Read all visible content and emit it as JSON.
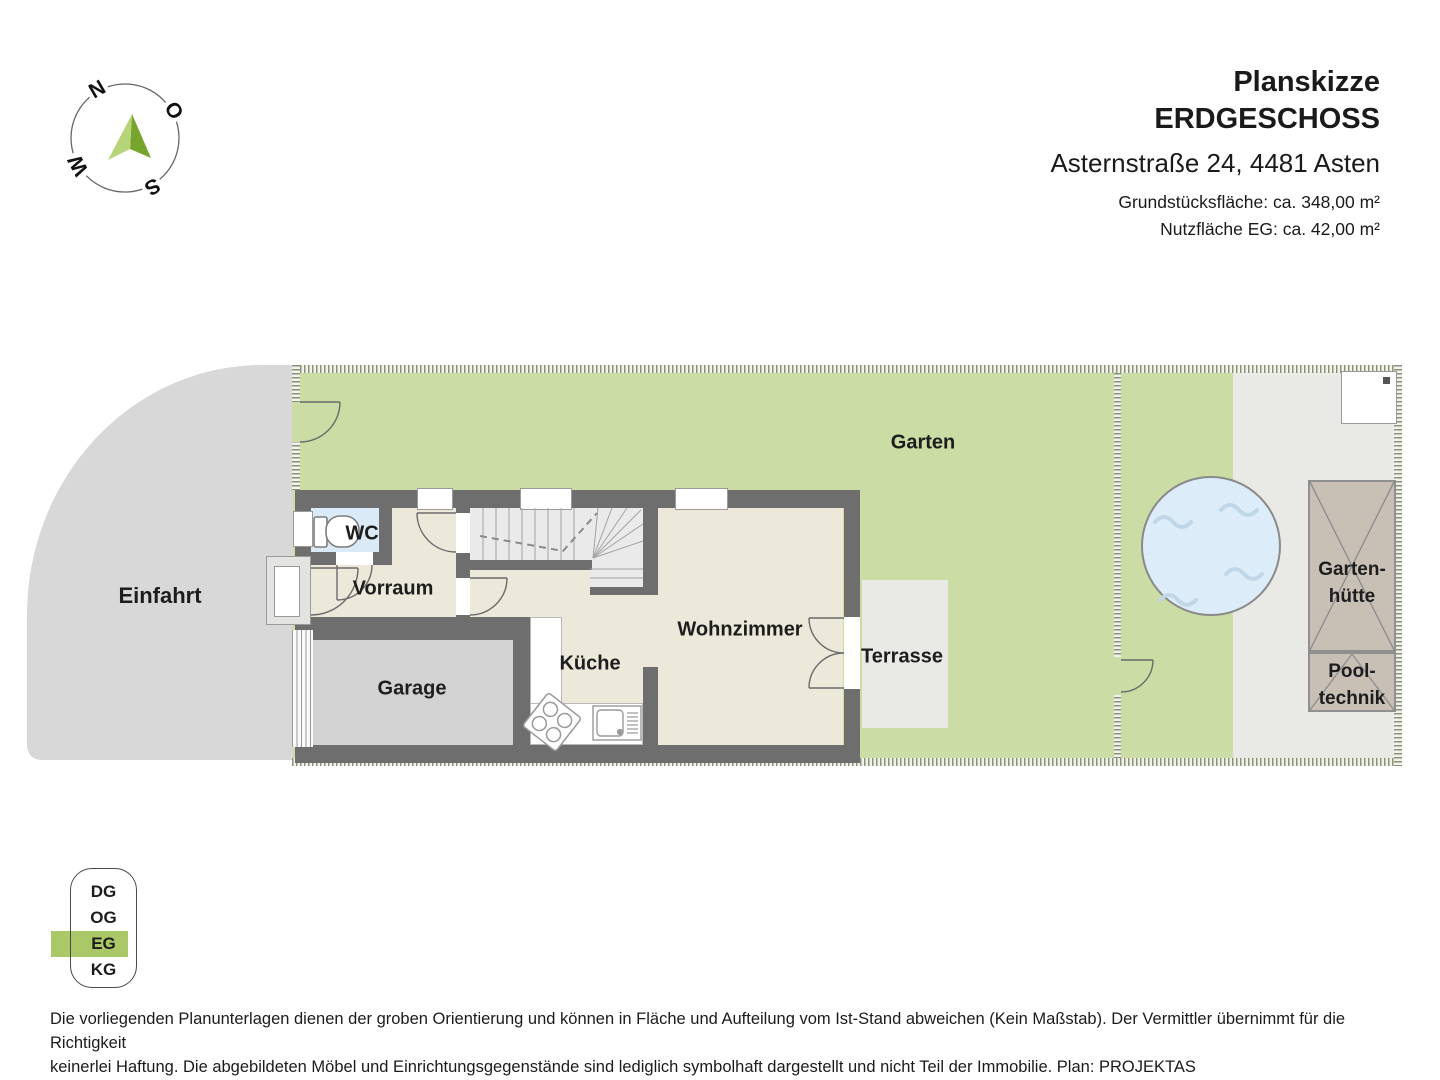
{
  "header": {
    "title_line1": "Planskizze",
    "title_line2": "ERDGESCHOSS",
    "address": "Asternstraße 24, 4481 Asten",
    "plot_area": "Grundstücksfläche: ca. 348,00 m²",
    "usable_area": "Nutzfläche EG: ca. 42,00 m²"
  },
  "compass": {
    "north": "N",
    "east": "O",
    "south": "S",
    "west": "W"
  },
  "plan": {
    "labels": {
      "einfahrt": "Einfahrt",
      "garten": "Garten",
      "wc": "WC",
      "vorraum": "Vorraum",
      "garage": "Garage",
      "kueche": "Küche",
      "wohnzimmer": "Wohnzimmer",
      "terrasse": "Terrasse",
      "gartenhuette_line1": "Garten-",
      "gartenhuette_line2": "hütte",
      "pooltechnik_line1": "Pool-",
      "pooltechnik_line2": "technik"
    }
  },
  "floor_selector": {
    "items": [
      {
        "label": "DG",
        "active": false
      },
      {
        "label": "OG",
        "active": false
      },
      {
        "label": "EG",
        "active": true
      },
      {
        "label": "KG",
        "active": false
      }
    ]
  },
  "footer": {
    "line1": "Die vorliegenden Planunterlagen dienen der groben Orientierung und können in Fläche und Aufteilung vom Ist-Stand abweichen (Kein Maßstab). Der Vermittler übernimmt für die Richtigkeit",
    "line2": "keinerlei Haftung. Die abgebildeten Möbel und Einrichtungsgegenstände sind lediglich symbolhaft dargestellt und nicht Teil der Immobilie. Plan: PROJEKTAS"
  },
  "colors": {
    "accent_green": "#abc869",
    "garden_green": "#cbdca4",
    "wall_gray": "#6e6e6e",
    "room_beige": "#ece8da",
    "wc_blue": "#daeaf7",
    "pool_blue": "#dcecf8",
    "hut_tan": "#c9c0b5"
  }
}
